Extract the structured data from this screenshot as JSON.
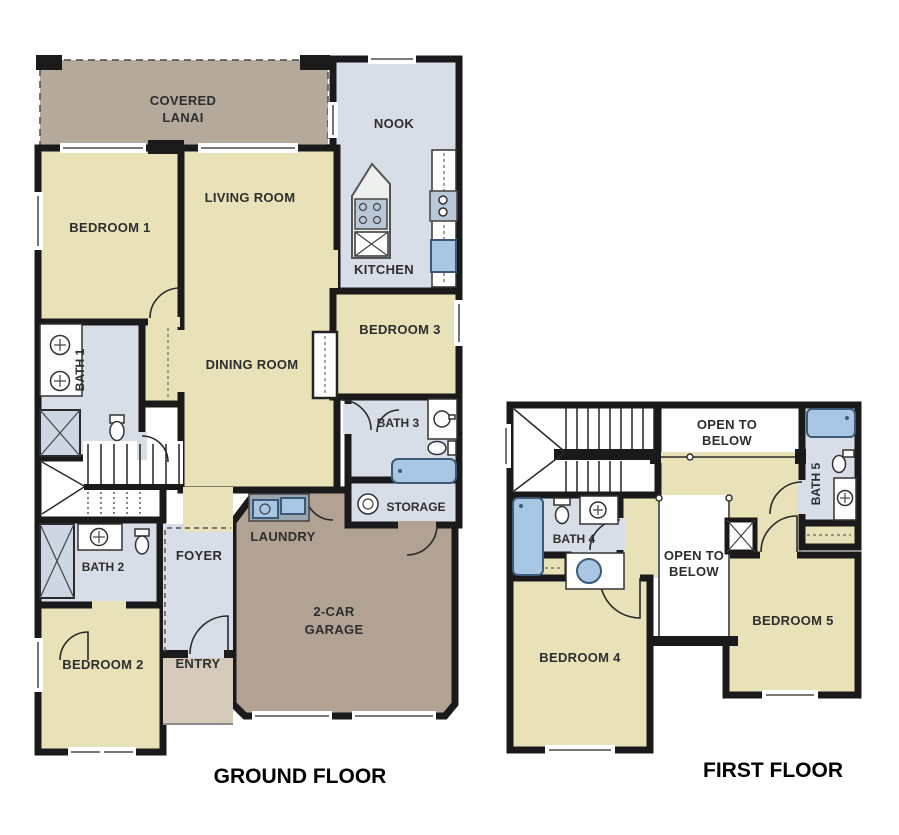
{
  "ground_floor": {
    "title": "GROUND FLOOR",
    "rooms": {
      "covered_lanai": {
        "line1": "COVERED",
        "line2": "LANAI"
      },
      "nook": "NOOK",
      "kitchen": "KITCHEN",
      "bedroom_1": "BEDROOM 1",
      "living_room": "LIVING ROOM",
      "dining_room": "DINING ROOM",
      "bedroom_3": "BEDROOM 3",
      "bath_1": "BATH 1",
      "bath_3": "BATH 3",
      "storage": "STORAGE",
      "laundry": "LAUNDRY",
      "foyer": "FOYER",
      "bath_2": "BATH 2",
      "bedroom_2": "BEDROOM 2",
      "entry": "ENTRY",
      "garage": {
        "line1": "2-CAR",
        "line2": "GARAGE"
      }
    }
  },
  "first_floor": {
    "title": "FIRST FLOOR",
    "rooms": {
      "open_to_below_top": {
        "line1": "OPEN TO",
        "line2": "BELOW"
      },
      "open_to_below_mid": {
        "line1": "OPEN TO",
        "line2": "BELOW"
      },
      "bath_5": "BATH 5",
      "bath_4": "BATH 4",
      "bedroom_4": "BEDROOM 4",
      "bedroom_5": "BEDROOM 5"
    }
  },
  "colors": {
    "wall": "#1a1a1a",
    "room_cream": "#e9e1b8",
    "room_blue": "#d8dee8",
    "lanai_brown": "#b4a99b",
    "garage_brown": "#b1a294",
    "entry_tan": "#d5cabc",
    "fixture_blue": "#a9c6e2"
  }
}
